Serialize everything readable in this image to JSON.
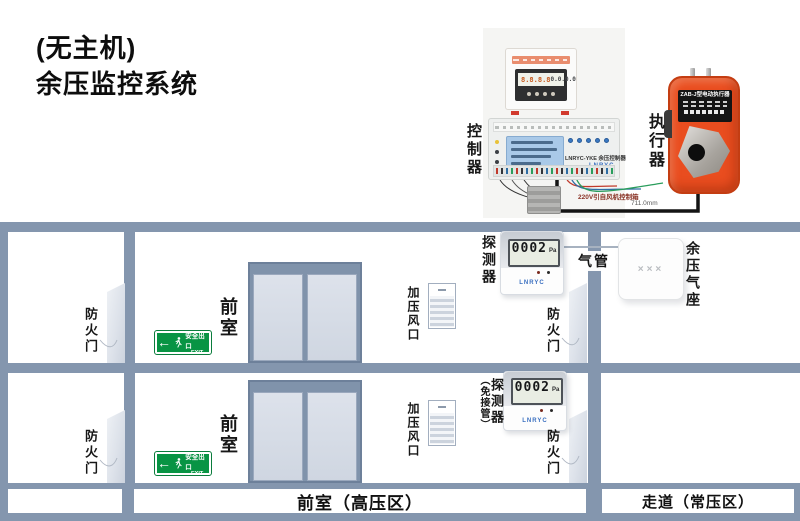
{
  "title": {
    "prefix": "(无主机)",
    "main": "余压监控系统"
  },
  "colors": {
    "structure_gray_blue": "#8496ae",
    "actuator_orange": "#e94d1f",
    "exit_sign_green": "#089444",
    "controller_lcd_blue": "#a9c9e8",
    "wire_black": "#141414",
    "wire_red": "#c0392b",
    "wire_blue": "#2e6da4",
    "wire_green": "#2a9d5c"
  },
  "controller": {
    "label": "控制器",
    "model": "LNRYC-YKE 余压控制器",
    "brand": "LNRYC",
    "display_left": "8.8.8.8",
    "display_right": "0.0.0.0",
    "wire_note": "220V引自风机控制箱",
    "wire_length": "711.0mm"
  },
  "actuator": {
    "label": "执行器",
    "model": "ZAB-J型电动执行器"
  },
  "detector_upper": {
    "label": "探测器",
    "reading": "0002",
    "unit": "Pa",
    "brand": "LNRYC"
  },
  "detector_lower": {
    "label": "探测器",
    "label_sub": "（免接管）",
    "reading": "0002",
    "unit": "Pa",
    "brand": "LNRYC"
  },
  "air_pipe": {
    "label": "气管"
  },
  "air_seat": {
    "label": "余压气座",
    "marking": "×××"
  },
  "rooms": {
    "upper_room": "前室",
    "lower_room": "前室",
    "fire_door": "防火门",
    "vent": "加压风口"
  },
  "exit_sign": {
    "text": "安全出口",
    "sub": "EXIT"
  },
  "footer": {
    "left": "前室（高压区）",
    "right": "走道（常压区）"
  }
}
